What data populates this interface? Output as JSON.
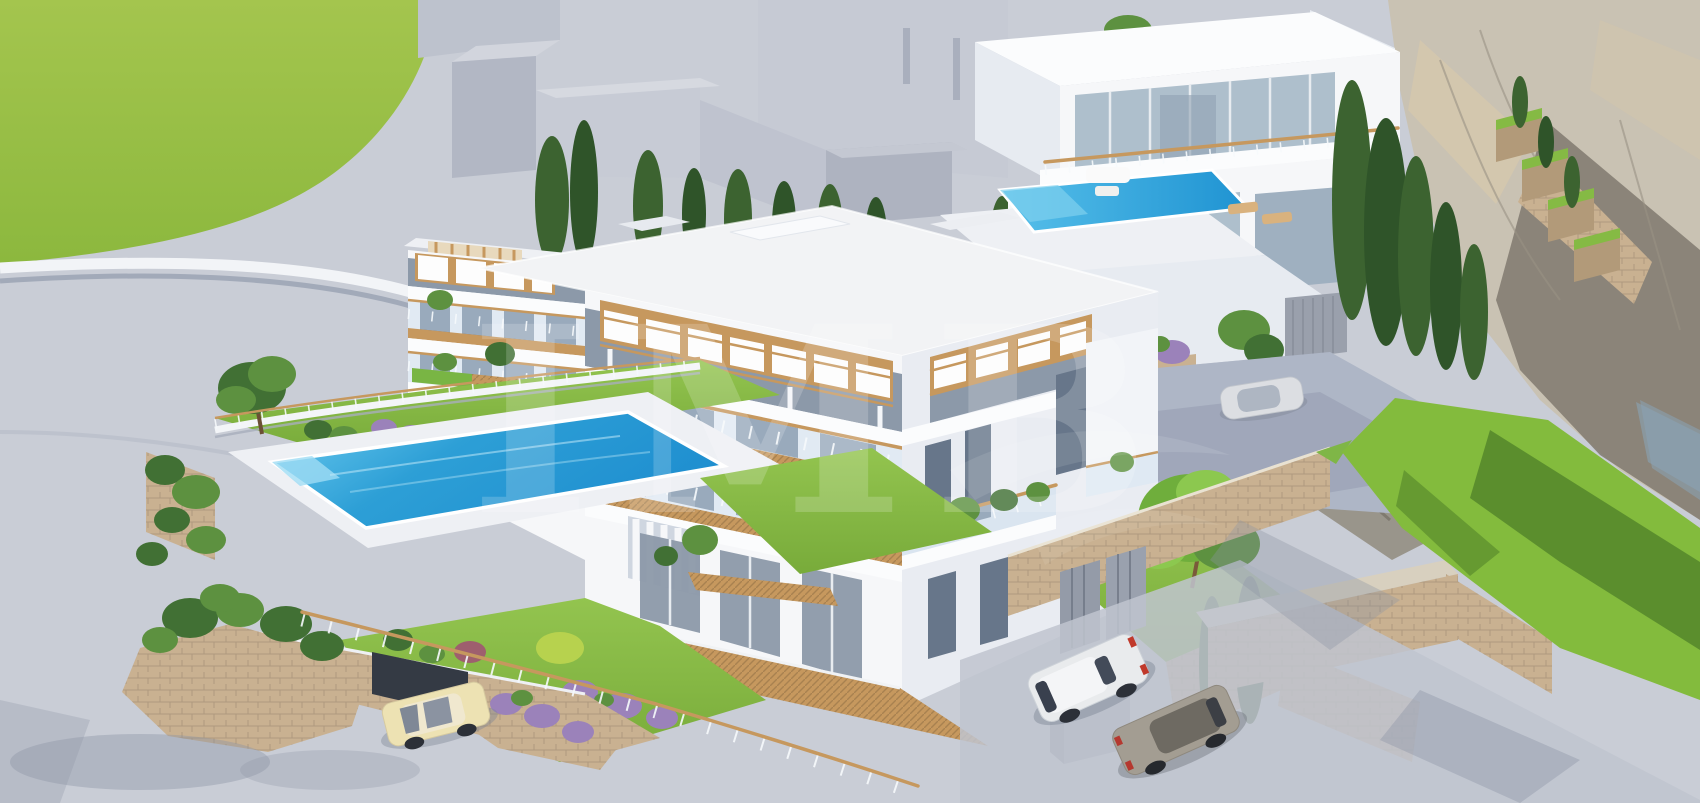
{
  "meta": {
    "title": "3D architectural rendering — modern white seaside apartment development",
    "view": "aerial three-quarter render, no UI chrome, no text except watermark"
  },
  "watermark": {
    "text": "IMB",
    "opacity": "0.18"
  },
  "palette": {
    "paving": "#c9cdd6",
    "paving_dark": "#c0c4cf",
    "grass_field": "#9abf45",
    "lawn": "#85ba44",
    "lawn_dark": "#4e7f28",
    "pool_blue": "#2196d4",
    "pool_light": "#63c8ee",
    "white_wall": "#f6f7f9",
    "gray_building": "#c2c6d2",
    "glass": "#8c99a9",
    "glass_light": "#aebfcc",
    "wood": "#c6985e",
    "stone": "#c9b191",
    "stone_dark": "#b29a79",
    "cliff": "#c9c2b3",
    "cliff_shadow": "#80796e",
    "tree": "#417034",
    "tree_light": "#5d9140",
    "cypress": "#3c6330",
    "car_white": "#e9ebed",
    "car_gray": "#a39d92",
    "car_cream": "#ede2b3",
    "flower_purple": "#9b82ba"
  },
  "scene": {
    "elements": [
      {
        "name": "grass-field",
        "desc": "bright green meadow, top left"
      },
      {
        "name": "plaza",
        "desc": "light gray curved paved terrace below meadow"
      },
      {
        "name": "background-buildings",
        "desc": "untextured gray context massing blocks, top center"
      },
      {
        "name": "cypress-row",
        "desc": "row of cypress trees behind main building"
      },
      {
        "name": "cliff",
        "desc": "tall tan rock face with deep shadow, right side"
      },
      {
        "name": "hillside-villa",
        "desc": "two-storey white villa with glass facade, top right"
      },
      {
        "name": "infinity-pool",
        "desc": "blue rooftop infinity pool of villa"
      },
      {
        "name": "main-apartment-building",
        "desc": "three-storey white apartment block, balconies with wood decks, glass railings, pergolas"
      },
      {
        "name": "swimming-pool",
        "desc": "rectangular blue pool with white deck, left"
      },
      {
        "name": "pool-garden",
        "desc": "lawns, flowering shrubs, lavender, tree"
      },
      {
        "name": "stone-retaining-walls",
        "desc": "tan dry-stone walls and planters"
      },
      {
        "name": "garage-opening",
        "desc": "dark garage entry under lawn terrace, bottom left"
      },
      {
        "name": "cream-car",
        "desc": "cream sedan entering garage"
      },
      {
        "name": "white-suv",
        "desc": "white hatchback parked bottom right"
      },
      {
        "name": "gray-sedan",
        "desc": "beige-gray sedan parked bottom right"
      },
      {
        "name": "silver-car-courtyard",
        "desc": "small silver car near villa driveway"
      },
      {
        "name": "parking-court",
        "desc": "gray paved parking and driveway ramp"
      },
      {
        "name": "terraced-walls",
        "desc": "stepped stone terraces with grass and small cypresses on cliff"
      },
      {
        "name": "bottom-right-lawn",
        "desc": "large lawn with tree shadows"
      },
      {
        "name": "watermark",
        "desc": "faint white serif watermark with wing swirl"
      }
    ]
  }
}
